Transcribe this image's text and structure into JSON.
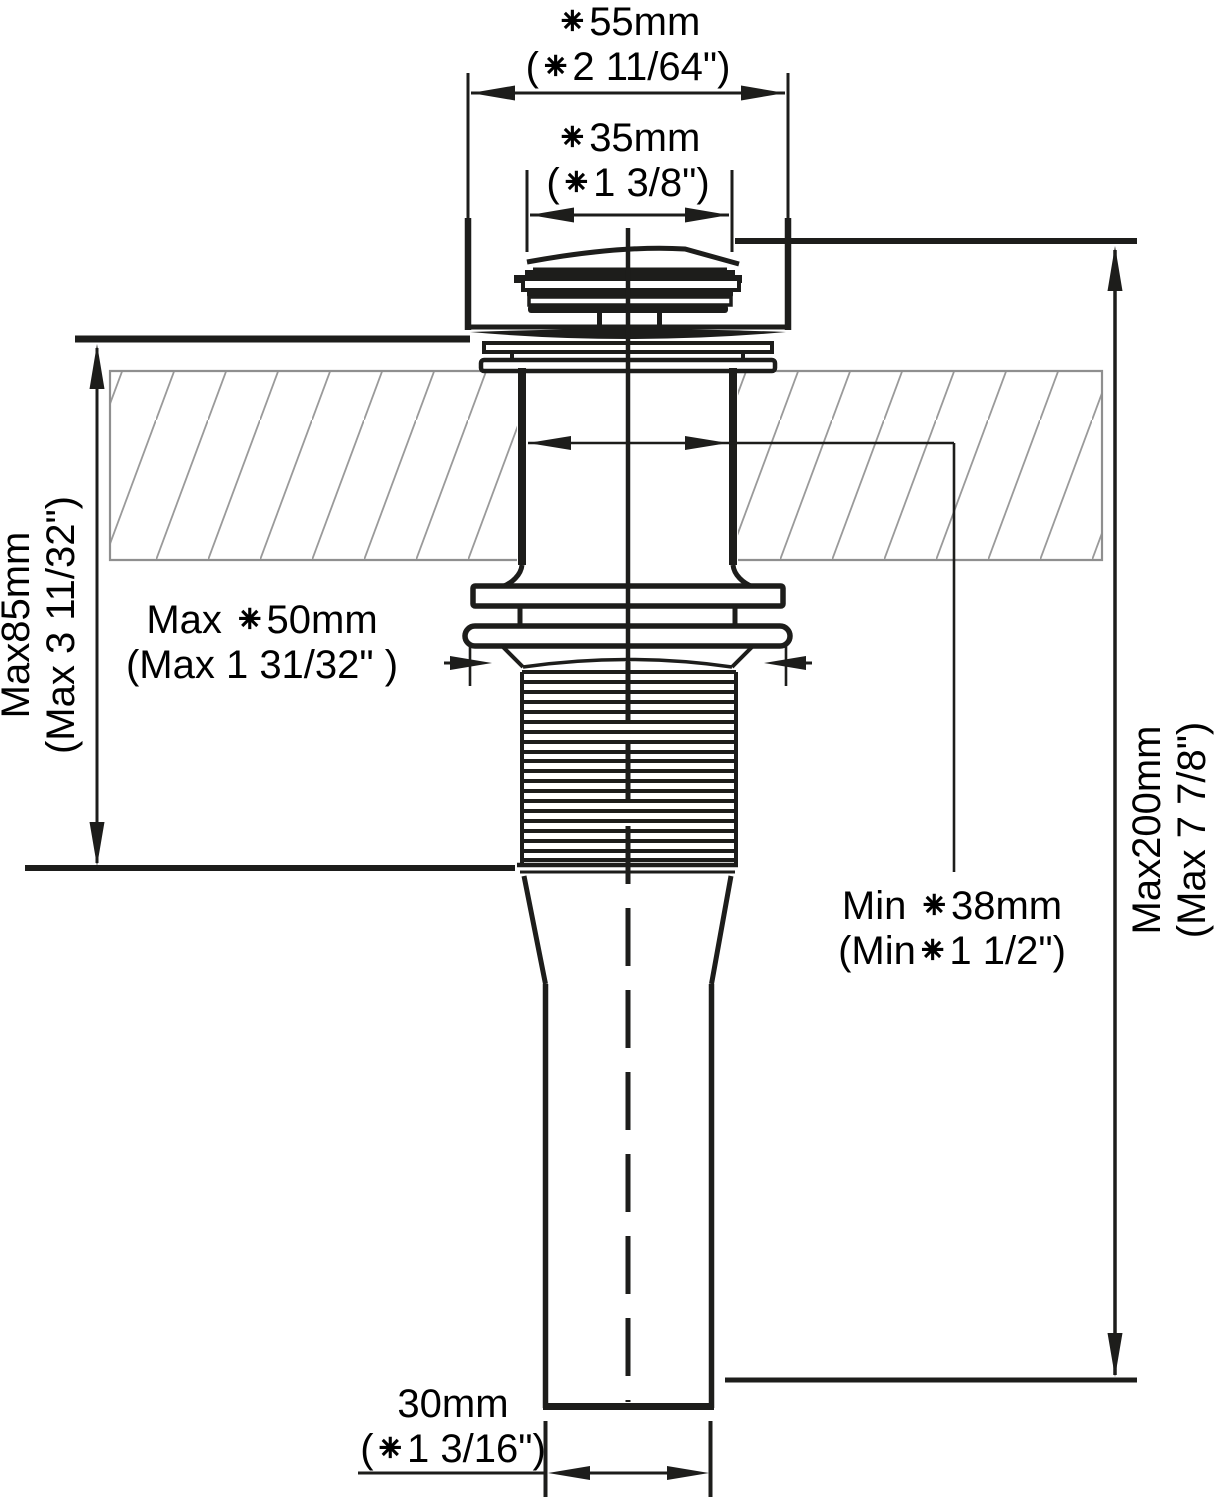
{
  "diagram": {
    "type": "technical-dimension-drawing",
    "subject": "Pop-up sink drain side profile installed through a hatched countertop cross-section",
    "colors": {
      "line": "#1d1d1b",
      "slab_line": "#8f8f8f",
      "hatch_line": "#9a9a9a",
      "background": "#ffffff",
      "text": "#000000"
    },
    "labels": {
      "cap_outer_diameter": {
        "line1": "⁕55mm",
        "line2": "(⁕2 11/64\")"
      },
      "cap_top_diameter": {
        "line1": "⁕35mm",
        "line2": "(⁕1 3/8\")"
      },
      "deck_thickness": {
        "line1": "Max85mm",
        "line2": "(Max 3 11/32\")"
      },
      "locknut_diameter": {
        "line1": "Max ⁕50mm",
        "line2": "(Max 1 31/32\" )"
      },
      "hole_diameter": {
        "line1": "Min ⁕38mm",
        "line2": "(Min⁕1 1/2\")"
      },
      "overall_length": {
        "line1": "Max200mm",
        "line2": "(Max 7 7/8\")"
      },
      "tailpipe_diameter": {
        "line1": "30mm",
        "line2": "(⁕1 3/16\")"
      }
    }
  }
}
